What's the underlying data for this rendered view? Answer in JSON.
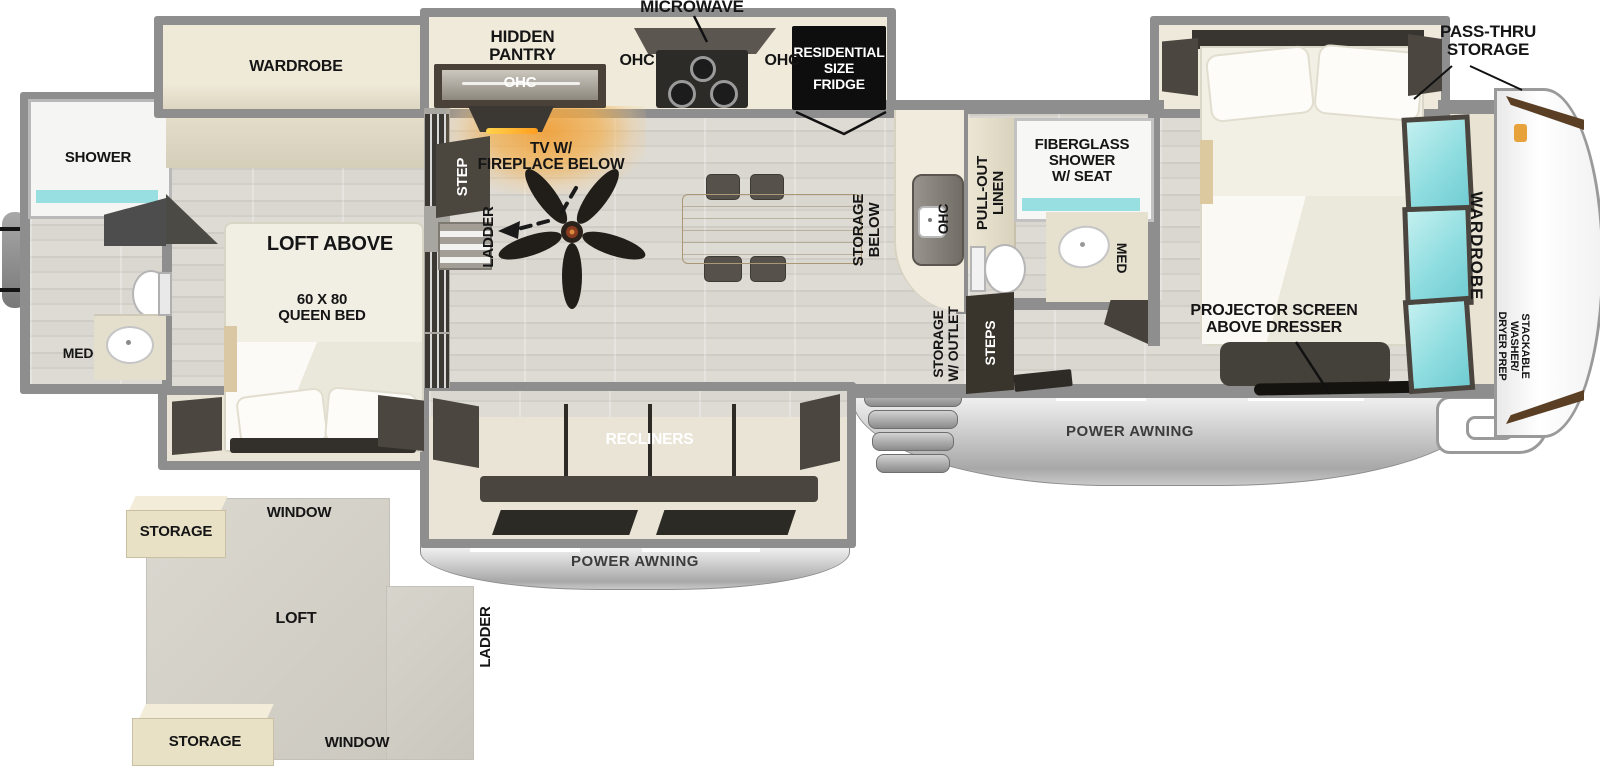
{
  "colors": {
    "wall_grey": "#8e8e8e",
    "floor_wood": "#d8d5cf",
    "cabinet_cream": "#ece7d8",
    "window_teal": "#8fdde0",
    "fireplace_orange": "#f0a13b",
    "dark_furniture": "#3e3a34",
    "appliance_black": "#0e0e0e"
  },
  "exterior": {
    "pass_thru_storage": "PASS-THRU\nSTORAGE",
    "power_awning_left": "POWER AWNING",
    "power_awning_right": "POWER AWNING"
  },
  "rear_bath": {
    "shower": "SHOWER",
    "med": "MED"
  },
  "rear_bedroom": {
    "wardrobe_slide": "WARDROBE",
    "loft_above": "LOFT ABOVE",
    "queen_bed": "60 X 80\nQUEEN BED"
  },
  "living": {
    "tv_fireplace": "TV W/\nFIREPLACE BELOW",
    "step": "STEP",
    "ladder": "LADDER",
    "recliners": "RECLINERS",
    "storage_below": "STORAGE\nBELOW"
  },
  "kitchen": {
    "microwave": "MICROWAVE",
    "hidden_pantry": "HIDDEN\nPANTRY",
    "ohc_pantry": "OHC",
    "ohc_left": "OHC",
    "ohc_right": "OHC",
    "fridge": "RESIDENTIAL\nSIZE\nFRIDGE",
    "ohc_sink": "OHC"
  },
  "mid_bath": {
    "pull_out_linen": "PULL-OUT\nLINEN",
    "fiberglass_shower": "FIBERGLASS\nSHOWER\nW/ SEAT",
    "med": "MED"
  },
  "stairs": {
    "storage_w_outlet": "STORAGE\nW/ OUTLET",
    "steps": "STEPS"
  },
  "front_bedroom": {
    "projector": "PROJECTOR SCREEN\nABOVE DRESSER",
    "wardrobe": "WARDROBE",
    "washer_dryer": "STACKABLE WASHER/\nDRYER PREP"
  },
  "loft_diagram": {
    "storage_top": "STORAGE",
    "window_top": "WINDOW",
    "loft": "LOFT",
    "ladder": "LADDER",
    "window_bottom": "WINDOW",
    "storage_bottom": "STORAGE"
  }
}
